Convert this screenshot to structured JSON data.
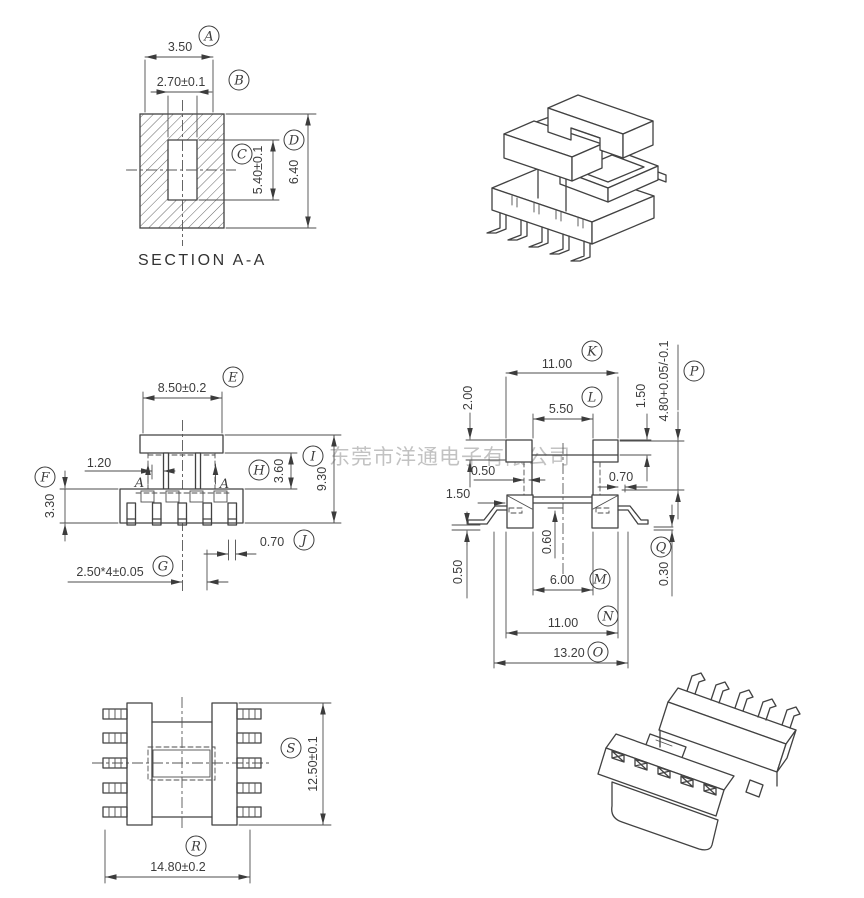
{
  "drawing": {
    "watermark": "东莞市洋通电子有限公司",
    "section_view": {
      "title": "SECTION A-A",
      "dims": {
        "a": {
          "label": "A",
          "value": "3.50"
        },
        "b": {
          "label": "B",
          "value": "2.70±0.1"
        },
        "c": {
          "label": "C",
          "value": "5.40±0.1"
        },
        "d": {
          "label": "D",
          "value": "6.40"
        }
      }
    },
    "front_view": {
      "section_marker": "A",
      "dims": {
        "e": {
          "label": "E",
          "value": "8.50±0.2"
        },
        "f": {
          "label": "F",
          "value": "3.30"
        },
        "g": {
          "label": "G",
          "value": "2.50*4±0.05"
        },
        "h": {
          "label": "H",
          "value": "3.60"
        },
        "i": {
          "label": "I",
          "value": "9.30"
        },
        "j": {
          "label": "J",
          "value": "0.70"
        }
      },
      "extra": {
        "d120": "1.20"
      }
    },
    "side_view": {
      "dims": {
        "k": {
          "label": "K",
          "value": "11.00"
        },
        "l": {
          "label": "L",
          "value": "5.50"
        },
        "m": {
          "label": "M",
          "value": "6.00"
        },
        "n": {
          "label": "N",
          "value": "11.00"
        },
        "o": {
          "label": "O",
          "value": "13.20"
        },
        "p": {
          "label": "P",
          "value": "4.80+0.05/-0.1"
        },
        "q": {
          "label": "Q",
          "value": "0.30"
        }
      },
      "extra": {
        "d200": "2.00",
        "d150top": "1.50",
        "d050mid": "0.50",
        "d070": "0.70",
        "d150left": "1.50",
        "d060": "0.60",
        "d050bot": "0.50"
      }
    },
    "top_view": {
      "dims": {
        "r": {
          "label": "R",
          "value": "14.80±0.2"
        },
        "s": {
          "label": "S",
          "value": "12.50±0.1"
        }
      }
    }
  }
}
